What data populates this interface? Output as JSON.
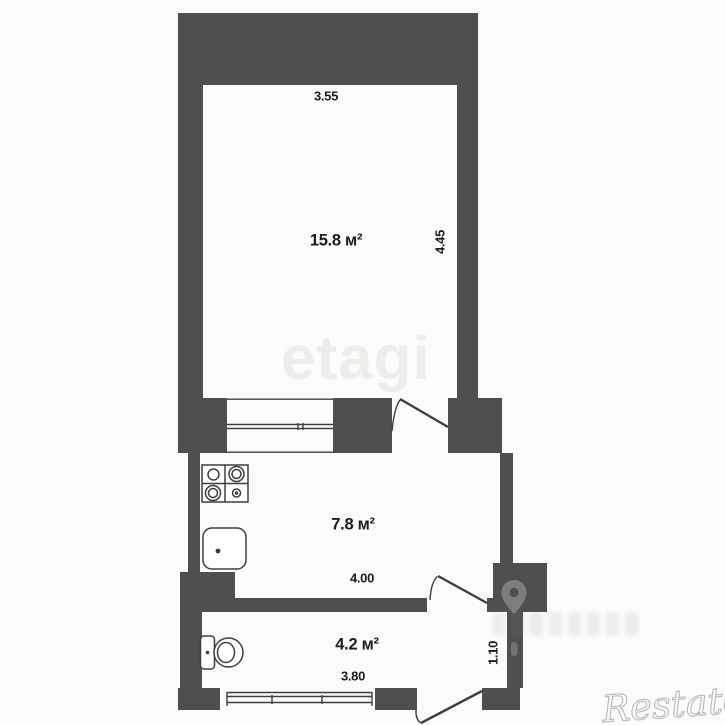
{
  "floor_plan": {
    "title": "apartment-floor-plan",
    "rooms": [
      {
        "name": "living-room",
        "area": "15.8 м²",
        "width": "3.55",
        "depth": "4.45"
      },
      {
        "name": "kitchen",
        "area": "7.8 м²",
        "width": "4.00"
      },
      {
        "name": "bathroom",
        "area": "4.2 м²",
        "width": "3.80",
        "depth": "1.10"
      }
    ],
    "fixtures": [
      "stove-icon",
      "sink-icon",
      "toilet-icon"
    ],
    "watermarks": {
      "center": "etagi",
      "corner": "Restate"
    },
    "colors": {
      "wall": "#4f4f52",
      "background": "#fbfbfc",
      "line": "#3e3e3e",
      "text": "#1c1c1c",
      "watermark_center": "#eceee9",
      "watermark_corner": "#a8a8a8"
    }
  }
}
